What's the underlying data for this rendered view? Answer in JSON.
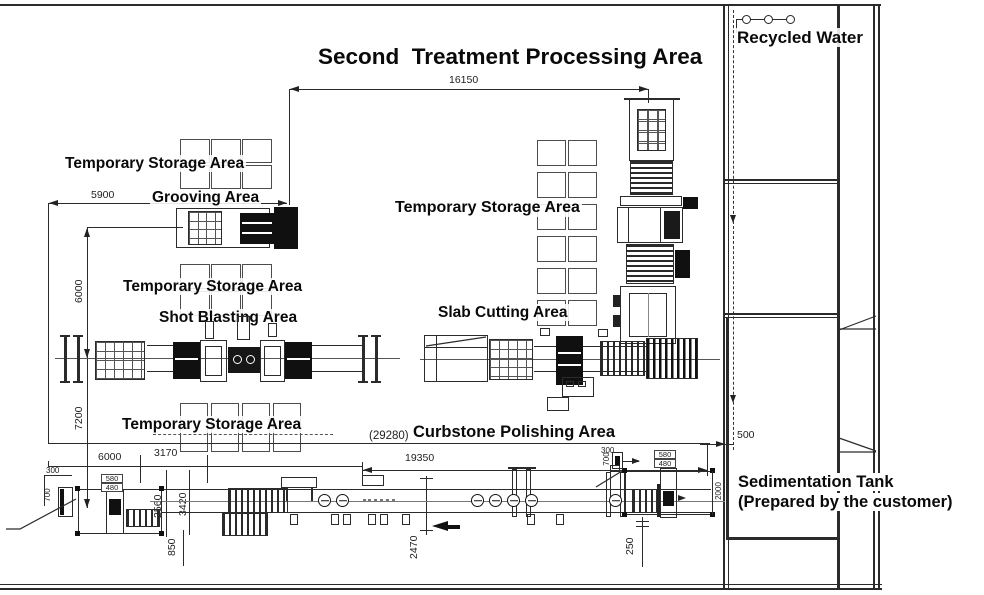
{
  "title": "Second  Treatment Processing Area",
  "areas": {
    "recycled_water": "Recycled Water",
    "storage_a": "Temporary Storage Area",
    "grooving": "Grooving Area",
    "storage_b": "Temporary Storage Area",
    "shot_blasting": "Shot Blasting Area",
    "storage_c": "Temporary Storage Area",
    "slab_cutting": "Slab Cutting Area",
    "storage_d": "Temporary Storage Area",
    "curbstone": "Curbstone Polishing Area",
    "sedimentation_1": "Sedimentation Tank",
    "sedimentation_2": "(Prepared by the customer)"
  },
  "dimensions": {
    "overall_top": "16150",
    "overall_bottom": "(29280)",
    "grooving_width": "5900",
    "left_gap_upper": "6000",
    "left_gap_lower": "7200",
    "bottom_seg_6000": "6000",
    "bottom_seg_3170": "3170",
    "polishing_length": "19350",
    "v_2560": "2560",
    "v_3420": "3420",
    "v_850": "850",
    "v_2470": "2470",
    "v_250": "250",
    "tank_gap": "500",
    "tank_height": "2000",
    "left_end_300": "300",
    "left_end_700": "700",
    "left_end_580": "580",
    "left_end_480": "480",
    "right_end_300": "300",
    "right_end_700": "700",
    "right_end_580": "580",
    "right_end_480": "480"
  },
  "storage_grids": {
    "a": {
      "cols": 3,
      "rows": 2
    },
    "b": {
      "cols": 3,
      "rows": 2
    },
    "c": {
      "cols": 2,
      "rows": 6
    },
    "d": {
      "cols": 4,
      "rows": 1
    }
  },
  "colors": {
    "line": "#2b2b2b",
    "text": "#111111",
    "background": "#ffffff"
  }
}
